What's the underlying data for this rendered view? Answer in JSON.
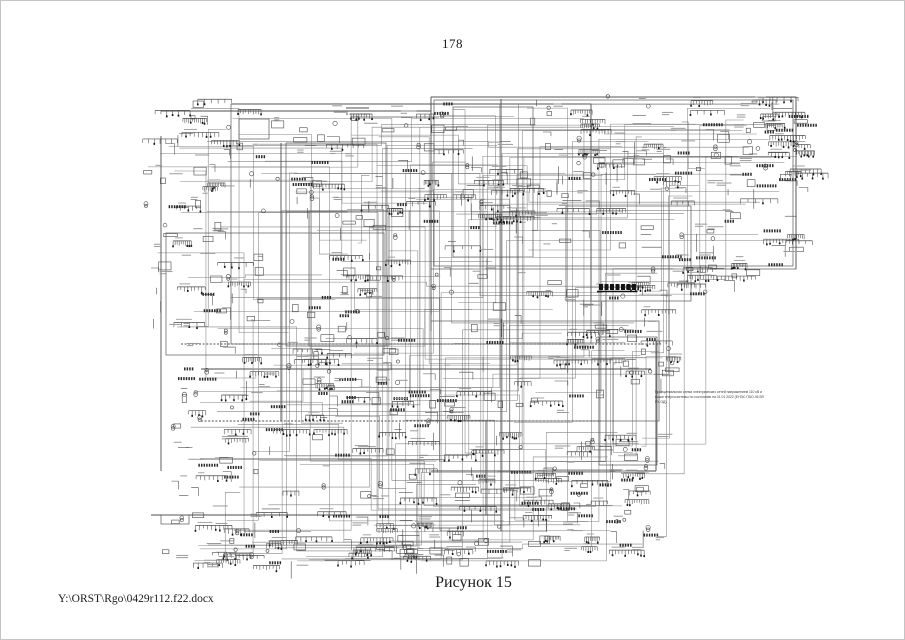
{
  "page": {
    "number": "178",
    "caption": "Рисунок 15",
    "footer_path": "Y:\\ORST\\Rgo\\0429r112.f22.docx"
  },
  "diagram": {
    "description": "Принципиальная схема электрических сетей энергосистемы (очень плотная однолинейная схема)",
    "annotation": {
      "line1": "Принципиальная схема электрических сетей напряжением 110 кВ и",
      "line2": "выше энергосистемы по состоянию на 01.01.2022 (ЕНЭС ПАО-46 ВЛ РУ-ОД)"
    },
    "colors": {
      "ink": "#4a4a4a",
      "ink_dark": "#161616",
      "ink_light": "#9a9a9a",
      "wire": "#6f6f6f"
    },
    "seed": 987431,
    "bounds": {
      "x": 140,
      "y": 90,
      "w": 662,
      "h": 475
    },
    "frames": [
      [
        430,
        96,
        365,
        172
      ],
      [
        433,
        99,
        359,
        166
      ],
      [
        452,
        106,
        80,
        150
      ],
      [
        285,
        142,
        100,
        203
      ],
      [
        230,
        103,
        360,
        240
      ],
      [
        165,
        232,
        218,
        122
      ],
      [
        308,
        210,
        80,
        135
      ],
      [
        565,
        205,
        125,
        95
      ],
      [
        430,
        320,
        228,
        100
      ],
      [
        238,
        118,
        30,
        20
      ],
      [
        160,
        514,
        28,
        9
      ],
      [
        598,
        336,
        58,
        128
      ]
    ],
    "buses": [
      {
        "x1": 230,
        "y1": 103,
        "x2": 590,
        "y2": 103
      },
      {
        "x1": 160,
        "y1": 110,
        "x2": 430,
        "y2": 110
      },
      {
        "x1": 430,
        "y1": 96,
        "x2": 795,
        "y2": 96
      },
      {
        "x1": 795,
        "y1": 96,
        "x2": 795,
        "y2": 268
      },
      {
        "x1": 160,
        "y1": 135,
        "x2": 160,
        "y2": 470
      },
      {
        "x1": 280,
        "y1": 142,
        "x2": 280,
        "y2": 420
      },
      {
        "x1": 500,
        "y1": 98,
        "x2": 500,
        "y2": 530
      },
      {
        "x1": 430,
        "y1": 96,
        "x2": 430,
        "y2": 330
      },
      {
        "x1": 180,
        "y1": 343,
        "x2": 660,
        "y2": 343,
        "dash": 1
      },
      {
        "x1": 200,
        "y1": 368,
        "x2": 650,
        "y2": 368
      },
      {
        "x1": 150,
        "y1": 514,
        "x2": 500,
        "y2": 514
      },
      {
        "x1": 485,
        "y1": 420,
        "x2": 485,
        "y2": 514
      },
      {
        "x1": 430,
        "y1": 470,
        "x2": 655,
        "y2": 470
      },
      {
        "x1": 655,
        "y1": 340,
        "x2": 655,
        "y2": 470
      },
      {
        "x1": 345,
        "y1": 107,
        "x2": 368,
        "y2": 107
      },
      {
        "x1": 345,
        "y1": 113,
        "x2": 368,
        "y2": 113,
        "dash": 1
      },
      {
        "x1": 590,
        "y1": 103,
        "x2": 590,
        "y2": 300
      },
      {
        "x1": 200,
        "y1": 420,
        "x2": 600,
        "y2": 420,
        "dash": 1
      }
    ],
    "dark_bus": {
      "x": 598,
      "y": 283,
      "cells": 7,
      "cell_w": 4,
      "cell_h": 6,
      "gap": 5.5
    },
    "clusters": [
      [
        140,
        95,
        95,
        70,
        18
      ],
      [
        235,
        100,
        190,
        55,
        26
      ],
      [
        430,
        98,
        160,
        35,
        16
      ],
      [
        600,
        95,
        200,
        85,
        40
      ],
      [
        740,
        100,
        60,
        80,
        18
      ],
      [
        140,
        165,
        80,
        70,
        22
      ],
      [
        150,
        235,
        110,
        95,
        34
      ],
      [
        300,
        200,
        100,
        100,
        30
      ],
      [
        240,
        145,
        140,
        70,
        22
      ],
      [
        390,
        135,
        130,
        95,
        30
      ],
      [
        455,
        140,
        140,
        90,
        32
      ],
      [
        540,
        130,
        120,
        100,
        30
      ],
      [
        660,
        180,
        140,
        100,
        40
      ],
      [
        700,
        95,
        100,
        80,
        24
      ],
      [
        600,
        230,
        120,
        70,
        26
      ],
      [
        560,
        280,
        100,
        60,
        22
      ],
      [
        430,
        235,
        130,
        90,
        28
      ],
      [
        285,
        300,
        110,
        100,
        30
      ],
      [
        160,
        340,
        100,
        70,
        22
      ],
      [
        165,
        410,
        100,
        70,
        24
      ],
      [
        260,
        330,
        150,
        80,
        26
      ],
      [
        300,
        375,
        150,
        60,
        22
      ],
      [
        420,
        330,
        180,
        80,
        30
      ],
      [
        560,
        320,
        100,
        50,
        16
      ],
      [
        430,
        420,
        170,
        90,
        30
      ],
      [
        260,
        420,
        160,
        80,
        26
      ],
      [
        160,
        480,
        110,
        80,
        28
      ],
      [
        270,
        490,
        150,
        70,
        30
      ],
      [
        400,
        480,
        180,
        80,
        34
      ],
      [
        530,
        430,
        130,
        90,
        26
      ],
      [
        560,
        500,
        100,
        50,
        18
      ],
      [
        600,
        430,
        60,
        60,
        14
      ],
      [
        620,
        340,
        60,
        40,
        10
      ],
      [
        330,
        520,
        180,
        40,
        22
      ],
      [
        190,
        540,
        120,
        25,
        14
      ]
    ],
    "connector_count": 140
  }
}
